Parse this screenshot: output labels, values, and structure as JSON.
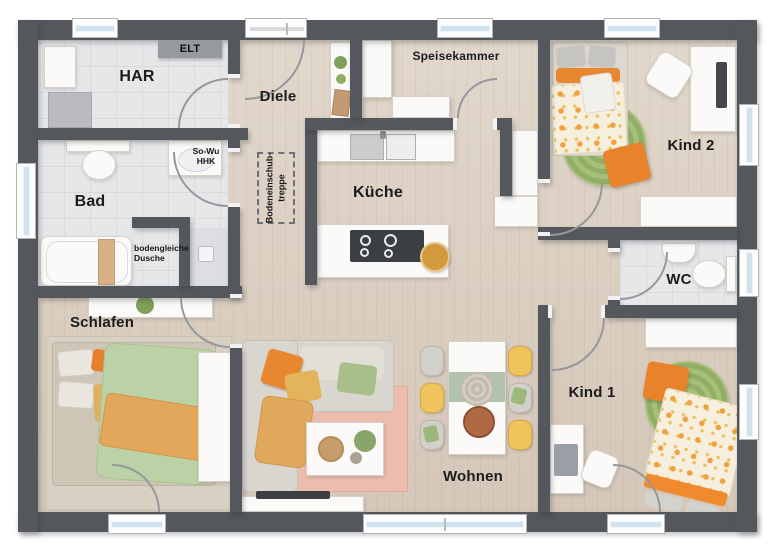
{
  "rooms": {
    "har": {
      "label": "HAR"
    },
    "elt": {
      "label": "ELT"
    },
    "diele": {
      "label": "Diele"
    },
    "speisekammer": {
      "label": "Speisekammer"
    },
    "kueche": {
      "label": "Küche"
    },
    "bad": {
      "label": "Bad"
    },
    "schlafen": {
      "label": "Schlafen"
    },
    "wohnen": {
      "label": "Wohnen"
    },
    "kind1": {
      "label": "Kind 1"
    },
    "kind2": {
      "label": "Kind 2"
    },
    "wc": {
      "label": "WC"
    }
  },
  "annotations": {
    "so_wu": {
      "line1": "So-Wu",
      "line2": "HHK"
    },
    "treppe": {
      "line1": "Bodeneinschub-",
      "line2": "treppe"
    },
    "dusche": {
      "line1": "bodengleiche",
      "line2": "Dusche"
    }
  },
  "colors": {
    "wall": "#54575c",
    "wood_floor": "#dbcec0",
    "tile_floor": "#e6e7e9",
    "window_glass": "#cfe2ee",
    "accent_orange": "#e8872f",
    "accent_yellow": "#e3b45c",
    "accent_green": "#a9bf8a",
    "rug_pink": "#ecbcae",
    "rug_green": "#9cb96e"
  }
}
